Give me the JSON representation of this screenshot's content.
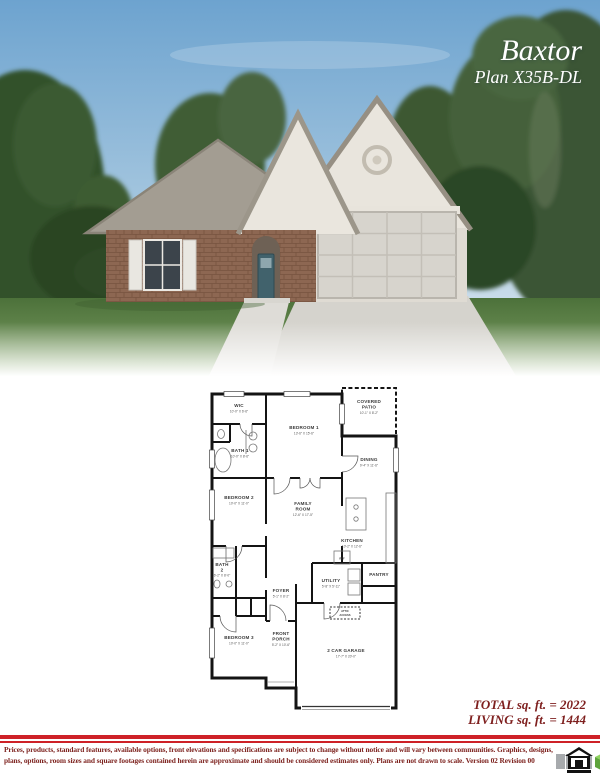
{
  "header": {
    "plan_name": "Baxtor",
    "plan_number": "Plan X35B-DL"
  },
  "floorplan": {
    "rooms": {
      "wic": {
        "label": "WIC",
        "dims": "10'-0\" X 6'-6\""
      },
      "bath1": {
        "label": "BATH 1",
        "dims": "10'-0\" X 8'-6\""
      },
      "bedroom1": {
        "label": "BEDROOM 1",
        "dims": "13'-6\" X 15'-6\""
      },
      "covered_patio": {
        "line1": "COVERED",
        "line2": "PATIO",
        "dims": "10'-1\" X 8'-2\""
      },
      "dining": {
        "label": "DINING",
        "dims": "9'-4\" X 11'-6\""
      },
      "bedroom2": {
        "label": "BEDROOM 2",
        "dims": "10'-0\" X 11'-0\""
      },
      "family_room": {
        "line1": "FAMILY",
        "line2": "ROOM",
        "dims": "12'-6\" X 17'-5\""
      },
      "kitchen": {
        "label": "KITCHEN",
        "dims": "10'-2\" X 12'-6\""
      },
      "pantry": {
        "label": "PANTRY"
      },
      "ref": {
        "label": "REF"
      },
      "bath2": {
        "line1": "BATH",
        "line2": "2",
        "dims": "6'-2\" X 8'-0\""
      },
      "utility": {
        "label": "UTILITY",
        "dims": "5'-8\" X 5'-11\""
      },
      "foyer": {
        "label": "FOYER",
        "dims": "5'-1\" X 8'-2\""
      },
      "bedroom3": {
        "label": "BEDROOM 3",
        "dims": "10'-0\" X 11'-0\""
      },
      "front_porch": {
        "line1": "FRONT",
        "line2": "PORCH",
        "dims": "5'-2\" X 10'-6\""
      },
      "garage": {
        "label": "2 CAR GARAGE",
        "dims": "17'-7\" X 20'-0\""
      },
      "attic": {
        "line1": "ATTIC",
        "line2": "ACCESS"
      }
    }
  },
  "totals": {
    "total": "TOTAL sq. ft. = 2022",
    "living": "LIVING sq. ft. = 1444"
  },
  "footer": {
    "disclaimer_line1": "Prices, products, standard features, available options, front elevations and specifications are subject to change without notice and will vary between communities.  Graphics, designs,",
    "disclaimer_line2": "plans, options, room sizes and square footages contained herein are approximate and should be considered estimates only.  Plans are not drawn to scale.   Version 02 Revision 00"
  },
  "colors": {
    "accent_red": "#ce2127",
    "maroon_text": "#7e2420",
    "sky_blue": "#6da3cf",
    "door_teal": "#41626c"
  }
}
